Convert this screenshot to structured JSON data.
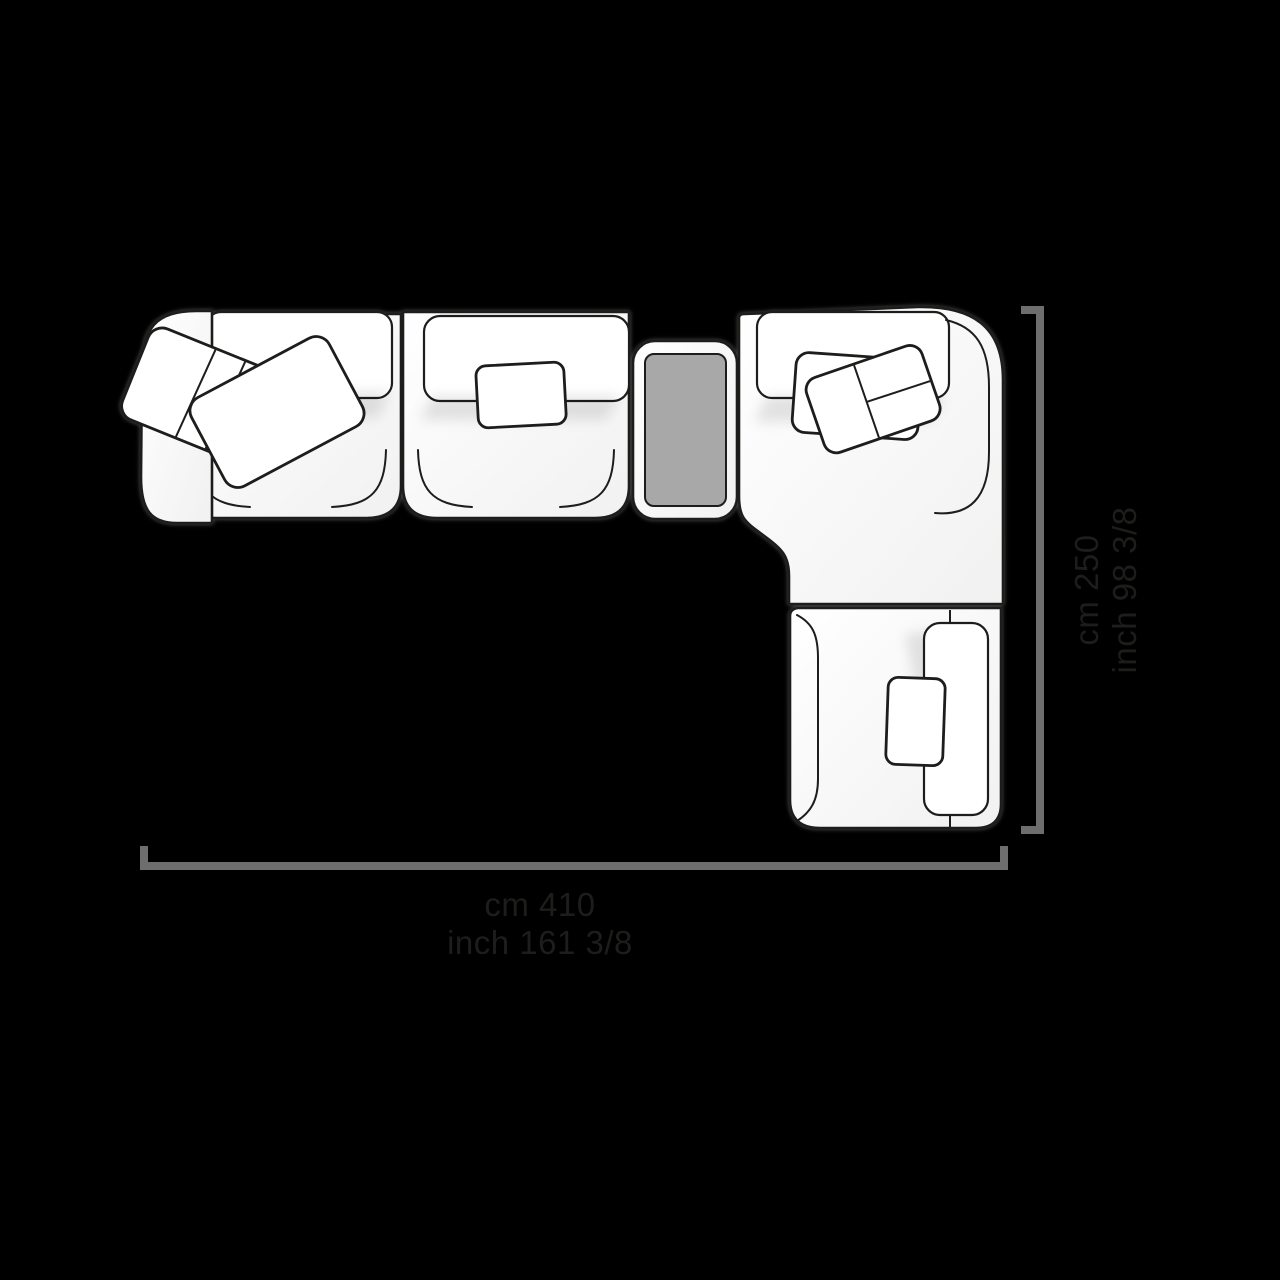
{
  "canvas": {
    "background_color": "#000000"
  },
  "sofa_diagram": {
    "view": "top-view-line-drawing",
    "pieces": [
      "left-arm-chaise-section",
      "middle-armless-section",
      "side-table",
      "corner-section",
      "right-arm-end-section"
    ],
    "colors": {
      "outline": "#1d1d1b",
      "upholstery_fill": "#ffffff",
      "table_top": "#a8a8a8",
      "dimension_line": "#6e6e6e",
      "label_text": "#1d1d1b"
    }
  },
  "dimensions": {
    "width": {
      "line1": "cm 410",
      "line2": "inch 161 3/8"
    },
    "depth": {
      "line1": "cm 250",
      "line2": "inch 98 3/8"
    }
  }
}
